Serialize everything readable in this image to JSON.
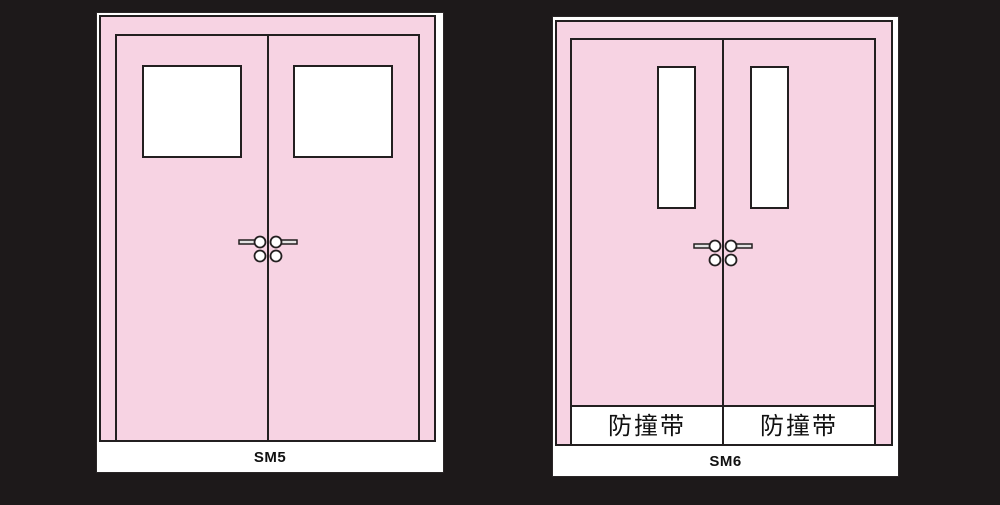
{
  "canvas": {
    "background": "#1d191a",
    "width": 1000,
    "height": 505
  },
  "colors": {
    "door_pink": "#f7d3e3",
    "outline_black": "#231f20",
    "panel_white": "#ffffff",
    "handle_grey": "#e3e3e3",
    "label_text": "#111111"
  },
  "icons": {
    "handles": "door-lever-handle-with-lock-cylinder-icon"
  },
  "panels": [
    {
      "label": "SM5"
    },
    {
      "label": "SM6",
      "strip_labels": [
        "防撞带",
        "防撞带"
      ]
    }
  ]
}
